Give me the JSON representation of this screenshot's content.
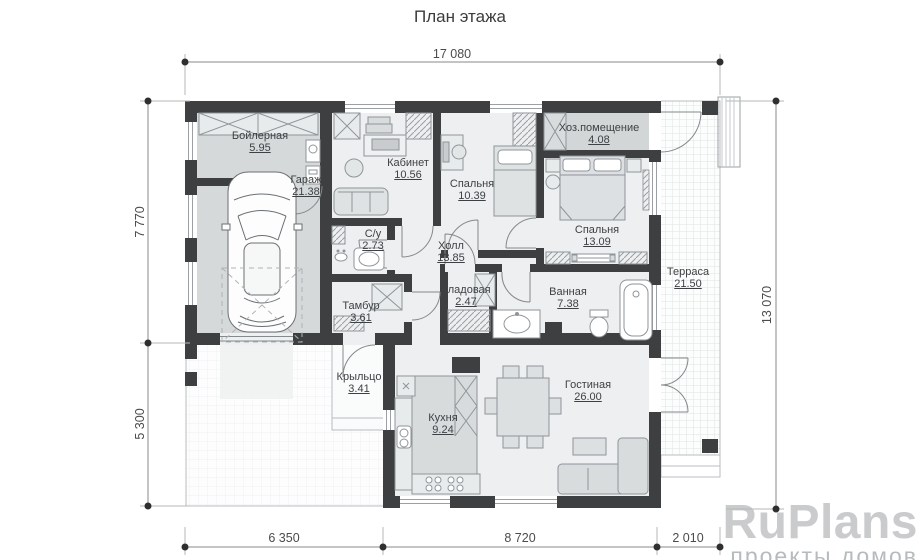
{
  "title": "План этажа",
  "dims": {
    "total_width": "17 080",
    "bottom_left": "6 350",
    "bottom_mid": "8 720",
    "bottom_right": "2 010",
    "left_upper": "7 770",
    "left_lower": "5 300",
    "right_total": "13 070"
  },
  "rooms": [
    {
      "name": "Бойлерная",
      "area": "5.95"
    },
    {
      "name": "Гараж",
      "area": "21.38"
    },
    {
      "name": "Кабинет",
      "area": "10.56"
    },
    {
      "name": "Спальня",
      "area": "10.39"
    },
    {
      "name": "Хоз.помещение",
      "area": "4.08"
    },
    {
      "name": "Спальня",
      "area": "13.09"
    },
    {
      "name": "С/у",
      "area": "2.73"
    },
    {
      "name": "Холл",
      "area": "13.85"
    },
    {
      "name": "Кладовая",
      "area": "2.47"
    },
    {
      "name": "Ванная",
      "area": "7.38"
    },
    {
      "name": "Терраса",
      "area": "21.50"
    },
    {
      "name": "Тамбур",
      "area": "3.61"
    },
    {
      "name": "Крыльцо",
      "area": "3.41"
    },
    {
      "name": "Кухня",
      "area": "9.24"
    },
    {
      "name": "Гостиная",
      "area": "26.00"
    }
  ],
  "watermark": {
    "brand": "RuPlans",
    "tagline": "проекты домов"
  },
  "colors": {
    "wall": "#3e3f40",
    "room_floor": "#edeff0",
    "garage_floor": "#d6d9da",
    "utility_floor": "#d3d6d7",
    "furniture_fill": "#e3e6e7",
    "dim_line": "#8a8a8a",
    "watermark_brand": "#c9cbcc",
    "watermark_tagline": "#b6bbbe"
  }
}
